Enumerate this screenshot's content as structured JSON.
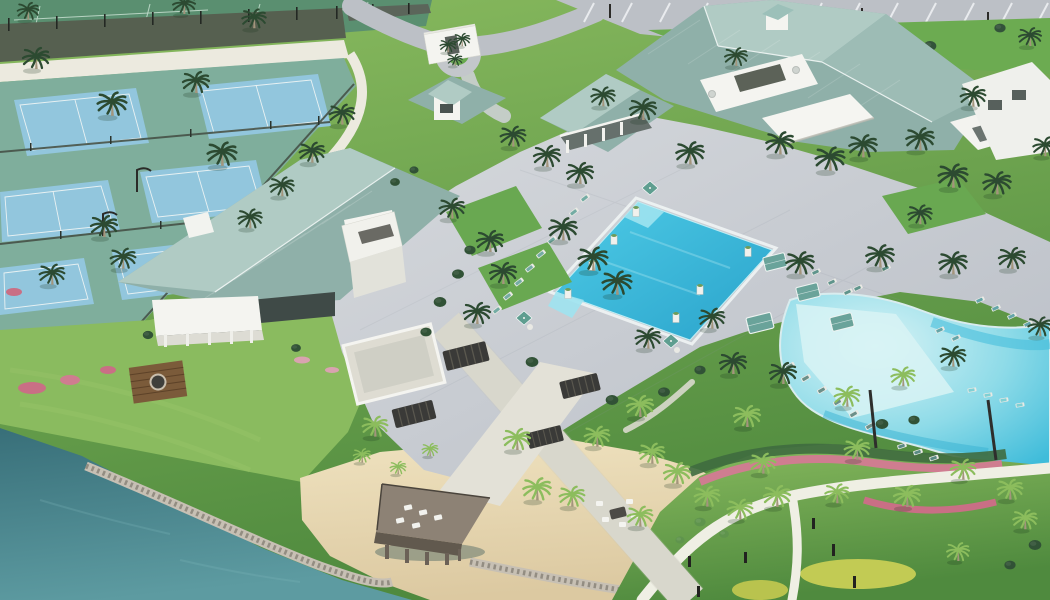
{
  "scene": {
    "type": "aerial-architectural-rendering",
    "caption": "Aerial 3D rendering of a resort-style community amenity campus with tennis and pickleball courts, clubhouse buildings with teal metal roofs, a rectangular lap pool, a lagoon-style beach-entry pool, palm-lined walkways, pergola swings, a sandy beach with a wooden dock and fire pit, and a lake in the foreground",
    "regions": [
      "tennis courts",
      "pickleball courts",
      "court windscreen fencing",
      "perimeter walking path",
      "entry drive and roundabout",
      "entry monument",
      "parking lot",
      "left clubhouse",
      "roof tower",
      "pool pavilion building",
      "main clubhouse",
      "pool deck plaza",
      "lap pool",
      "lagoon pool",
      "cabanas and umbrellas",
      "lounge chairs",
      "palm promenade",
      "pergola swings",
      "privacy wood wall",
      "south lawn and gardens",
      "flower beds",
      "beach",
      "rock revetment",
      "dock",
      "fire pit lounge",
      "lake"
    ]
  },
  "palette": {
    "grass_base": "#69a851",
    "grass_light": "#8abb5f",
    "grass_dark": "#4f8a3e",
    "tennis_green": "#5a8f70",
    "hedge_dark": "#566050",
    "court_surround": "#7fae9c",
    "court_blue": "#92c6dd",
    "path_white": "#eceadf",
    "asphalt": "#bcc0c6",
    "paver_light": "#d6d9dd",
    "paver_dark": "#b9bec6",
    "roof_teal": "#8fb0a9",
    "roof_light": "#b0cbc4",
    "wall_white": "#f4f4f0",
    "pool_turquoise": "#4ecbe6",
    "pool_deep": "#2aa3cb",
    "pool_step": "#9fe3ef",
    "lagoon_shallow": "#d8f3f5",
    "lagoon_mid": "#8edbe8",
    "lagoon_deep": "#3fbcda",
    "lake_deep": "#386f79",
    "lake_light": "#5d9ba1",
    "sand": "#efe2bf",
    "sand_dark": "#dcc9a1",
    "rock_gray": "#c7c0b4",
    "deck_wood": "#8d8275",
    "wood_wall": "#7b5b3a",
    "pergola_dark": "#3a3a38",
    "cabana_teal": "#6aa39a",
    "umbrella_teal": "#5f9e90",
    "chaise_teal": "#74aca4",
    "palm_dark": "#2c4a31",
    "palm_light": "#8cbd5d",
    "flower_pink": "#cf7d90",
    "flower_yellow": "#c2cb54"
  }
}
